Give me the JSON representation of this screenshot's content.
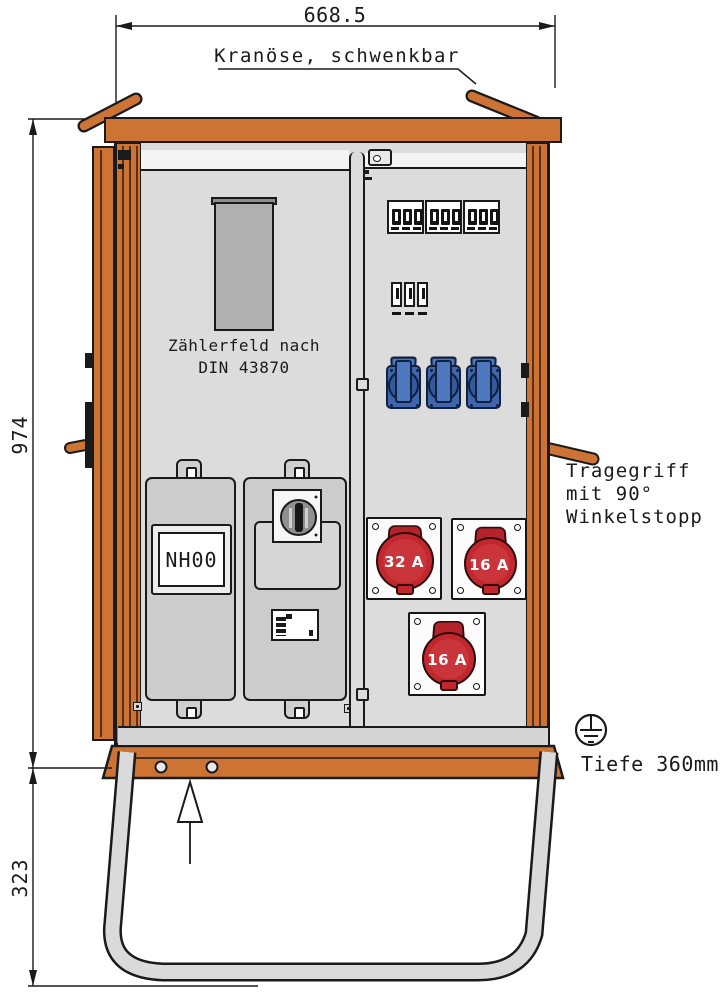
{
  "dimensions": {
    "width": "668.5",
    "height": "974",
    "stand_height": "323",
    "depth": "Tiefe 360mm"
  },
  "labels": {
    "crane": "Kranöse, schwenkbar",
    "carry_handle": [
      "Tragegriff",
      "mit 90°",
      "Winkelstopp"
    ],
    "meter_field": [
      "Zählerfeld nach",
      "DIN 43870"
    ],
    "fuse": "NH00"
  },
  "sockets": {
    "cee": [
      {
        "label": "32 A"
      },
      {
        "label": "16 A"
      },
      {
        "label": "16 A"
      }
    ],
    "schuko_count": 3
  },
  "breakers": {
    "triple_groups": 3,
    "single_row_poles": 3
  },
  "colors": {
    "frame_orange": "#CD7434",
    "panel_gray": "#DCDCDC",
    "cee_red": "#C1272D",
    "schuko_blue": "#3F66AB",
    "outline": "#1A1A1A"
  }
}
